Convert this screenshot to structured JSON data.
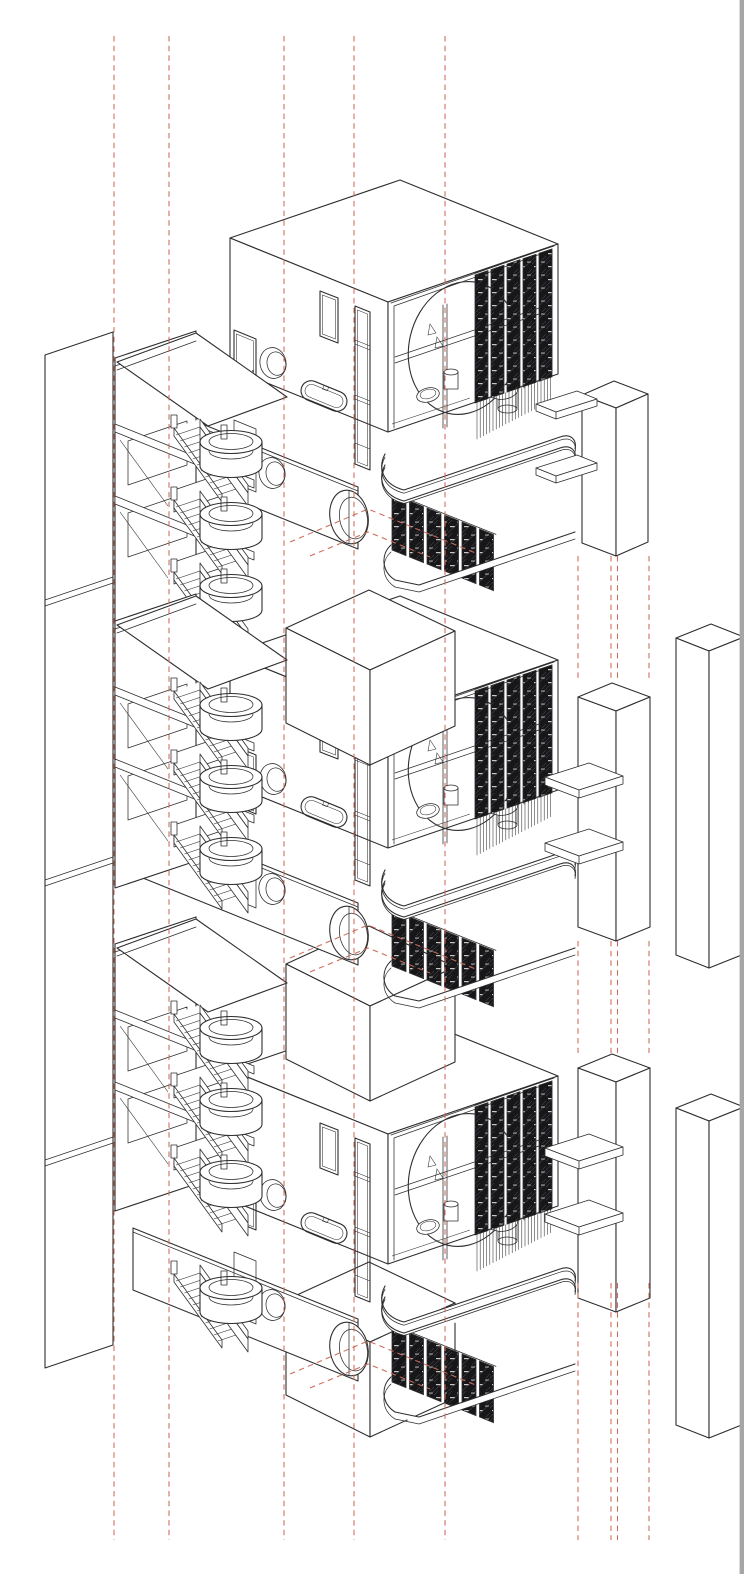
{
  "document": {
    "kind": "architectural exploded axonometric drawing",
    "subject": "stacked modular bathroom units with stair tower, balconies and structural columns",
    "repeated_units": 3,
    "visible_text": ""
  },
  "palette": {
    "paper": "#ffffff",
    "line": "#2e2e2e",
    "louver_dark": "#17171a",
    "louver_hatch": "#3c3c41",
    "louver_dash": "#e6e6e6",
    "guide_red": "#cc6a58",
    "page_border": "#a6a6a6"
  },
  "layout": {
    "canvas": [
      744,
      1574
    ],
    "unit_offsets": [
      0,
      416,
      832
    ],
    "shaft_offsets": [
      0,
      336,
      672
    ],
    "stair_bay_offsets": [
      0,
      263,
      586
    ],
    "extra_flight_offsets": [
      774
    ],
    "column_b_offsets": [
      0,
      371
    ],
    "far_column_offsets": [
      0,
      470
    ],
    "guide_lines": {
      "full_x": [
        114,
        169,
        284,
        354,
        445
      ],
      "full_span": [
        36,
        1540
      ],
      "right_x": [
        578,
        611,
        617.5,
        649
      ],
      "right_segments": [
        [
          556,
          682
        ],
        [
          941,
          1053
        ],
        [
          1283,
          1540
        ]
      ]
    },
    "fringe": {
      "x0": 477,
      "x1": 553,
      "step": 3.2,
      "slope": -0.34,
      "base_y": 403,
      "length": 37
    }
  },
  "module": {
    "fixtures": [
      "entry-door",
      "porthole-window",
      "bathtub",
      "slot-window",
      "full-height-window",
      "circular-cutaway",
      "toilet",
      "cistern",
      "wash-basin",
      "grab-rails",
      "louver-screen"
    ],
    "portholes_per_unit": {
      "small": 2,
      "large": 1
    }
  },
  "stairs": {
    "bays": 3,
    "flights_per_bay": 3,
    "treads_per_flight": 11,
    "landing_type": "round-drum"
  },
  "icons": {
    "porthole-icon": "ellipse-ring",
    "stair-icon": "zigzag-treads"
  }
}
